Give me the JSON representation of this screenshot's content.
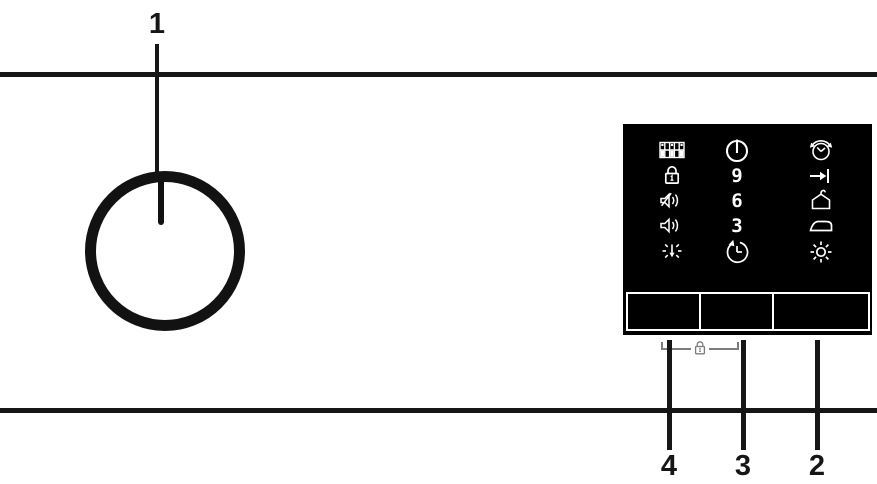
{
  "figure": {
    "description": "Appliance control panel diagram with program knob and touch button panel"
  },
  "callouts": {
    "knob_label": "1",
    "button_left_label": "4",
    "button_middle_label": "3",
    "button_right_label": "2"
  },
  "panel": {
    "delay_hours": [
      "9",
      "6",
      "3"
    ],
    "icons": {
      "left_column": [
        "display-matrix-icon",
        "child-lock-icon",
        "sound-off-icon",
        "sound-on-icon",
        "drum-light-icon"
      ],
      "center_column": [
        "power-icon",
        "delay-start-clock-icon"
      ],
      "right_column": [
        "time-saver-clock-icon",
        "arrow-to-end-icon",
        "hanger-icon",
        "iron-icon",
        "sun-icon"
      ],
      "bracket_icon": "child-lock-key-icon"
    },
    "buttons": [
      "button-left",
      "button-middle",
      "button-right"
    ]
  },
  "colors": {
    "background": "#ffffff",
    "line": "#161616",
    "panel_background": "#000000",
    "icon": "#ffffff",
    "bracket": "#7d7d7d"
  }
}
